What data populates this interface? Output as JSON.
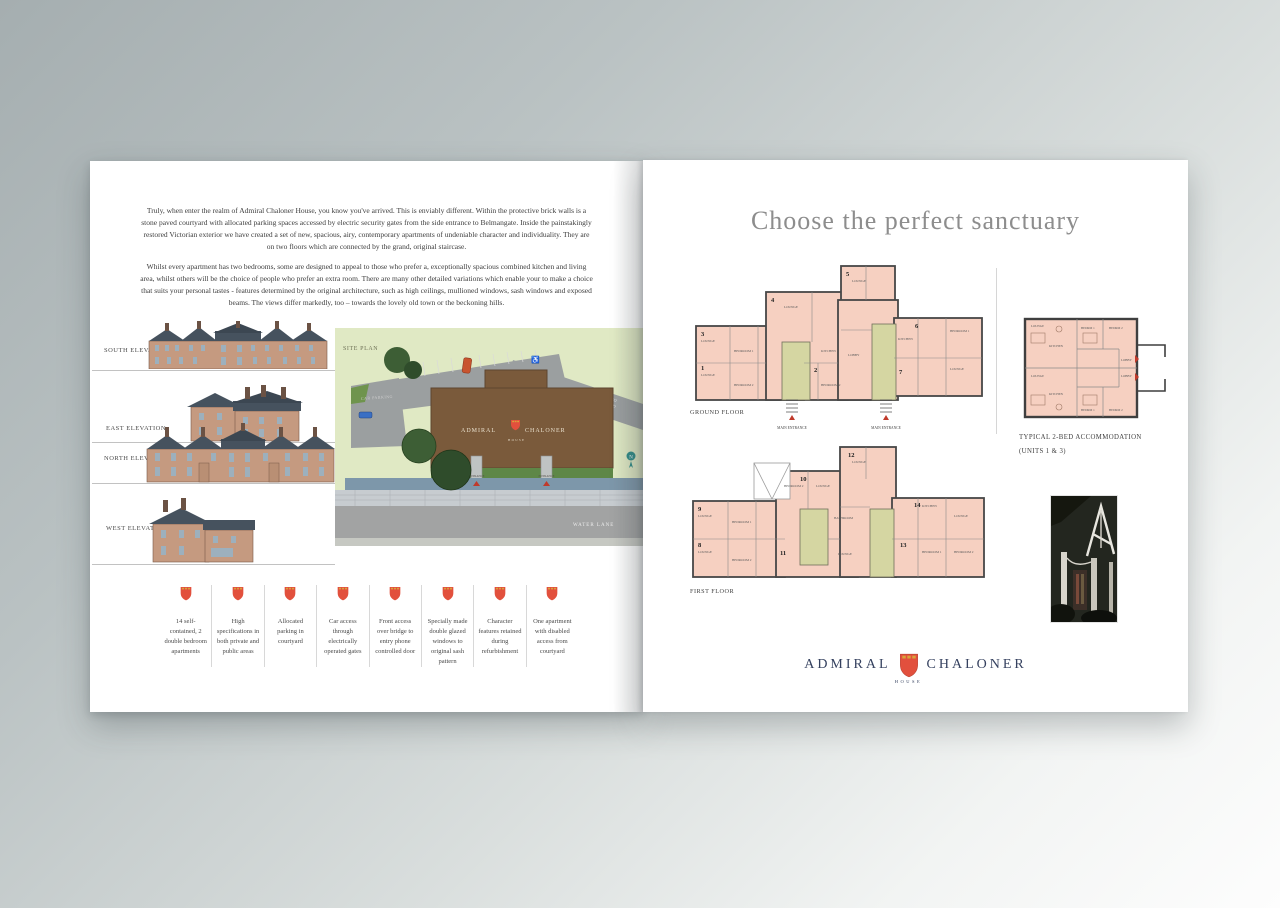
{
  "left_page": {
    "intro_paragraph_1": "Truly, when enter the realm of Admiral Chaloner House, you know you've arrived. This is enviably different.  Within the protective brick walls is a stone paved courtyard with allocated parking spaces accessed by electric security gates from the side entrance to Belmangate.  Inside the painstakingly restored Victorian exterior we have created a set of new, spacious, airy, contemporary apartments of undeniable character and individuality.  They are on two floors which are connected by the grand, original staircase.",
    "intro_paragraph_2": "Whilst every apartment has two bedrooms, some are designed to appeal to those who prefer a, exceptionally spacious combined kitchen and living area, whilst others will be the choice of people who prefer an extra room. There are many other detailed variations which enable your to make a choice that suits your personal tastes - features determined by the original architecture, such as high ceilings, mullioned windows, sash windows and exposed beams. The views differ markedly, too – towards the lovely old town or the beckoning hills.",
    "elevations": [
      {
        "label": "SOUTH ELEVATION"
      },
      {
        "label": "EAST ELEVATION"
      },
      {
        "label": "NORTH ELEVATION"
      },
      {
        "label": "WEST ELEVATION"
      }
    ],
    "site_plan": {
      "label": "SITE PLAN",
      "building_name_left": "ADMIRAL",
      "building_name_right": "CHALONER",
      "building_sub": "HOUSE",
      "car_parking_label": "CAR PARKING",
      "entrance_label": "ENTRANCE",
      "water_lane_label": "WATER LANE",
      "access_road_label_1": "MAIN ACCESS TO",
      "access_road_label_2": "BELMANGATE RD"
    },
    "features": [
      {
        "text": "14 self-contained, 2 double bedroom apartments"
      },
      {
        "text": "High specifications in both private and public areas"
      },
      {
        "text": "Allocated parking in courtyard"
      },
      {
        "text": "Car access through electrically operated gates"
      },
      {
        "text": "Front access over bridge to entry phone controlled door"
      },
      {
        "text": "Specially made double glazed windows to original sash pattern"
      },
      {
        "text": "Character features retained during refurbishment"
      },
      {
        "text": "One apartment with disabled access from courtyard"
      }
    ]
  },
  "right_page": {
    "title": "Choose the perfect sanctuary",
    "ground_floor": {
      "label": "GROUND FLOOR",
      "entrance_label": "MAIN ENTRANCE",
      "units": [
        "1",
        "2",
        "3",
        "4",
        "5",
        "6",
        "7"
      ]
    },
    "first_floor": {
      "label": "FIRST FLOOR",
      "units": [
        "8",
        "9",
        "10",
        "11",
        "12",
        "13",
        "14"
      ]
    },
    "room_labels": {
      "lounge": "LOUNGE",
      "bedroom1": "BEDROOM 1",
      "bedroom2": "BEDROOM 2",
      "kitchen": "KITCHEN",
      "lobby": "LOBBY",
      "bathroom": "BATHROOM",
      "bedrm1": "BEDRM 1",
      "bedrm2": "BEDRM 2"
    },
    "typical_unit": {
      "caption_line1": "TYPICAL 2-BED ACCOMMODATION",
      "caption_line2": "(UNITS 1 & 3)"
    },
    "logo": {
      "left": "ADMIRAL",
      "right": "CHALONER",
      "sub": "HOUSE"
    }
  },
  "colors": {
    "shield_red": "#e2503d",
    "shield_gold": "#d9a43a",
    "plan_room_pink": "#f6d0c1",
    "plan_stair_olive": "#d5d6a2",
    "site_green": "#e0e9c4",
    "road_grey": "#9b9fa0",
    "building_brown": "#7a5a3b",
    "logo_navy": "#35415f",
    "title_grey": "#8d8d8d"
  }
}
